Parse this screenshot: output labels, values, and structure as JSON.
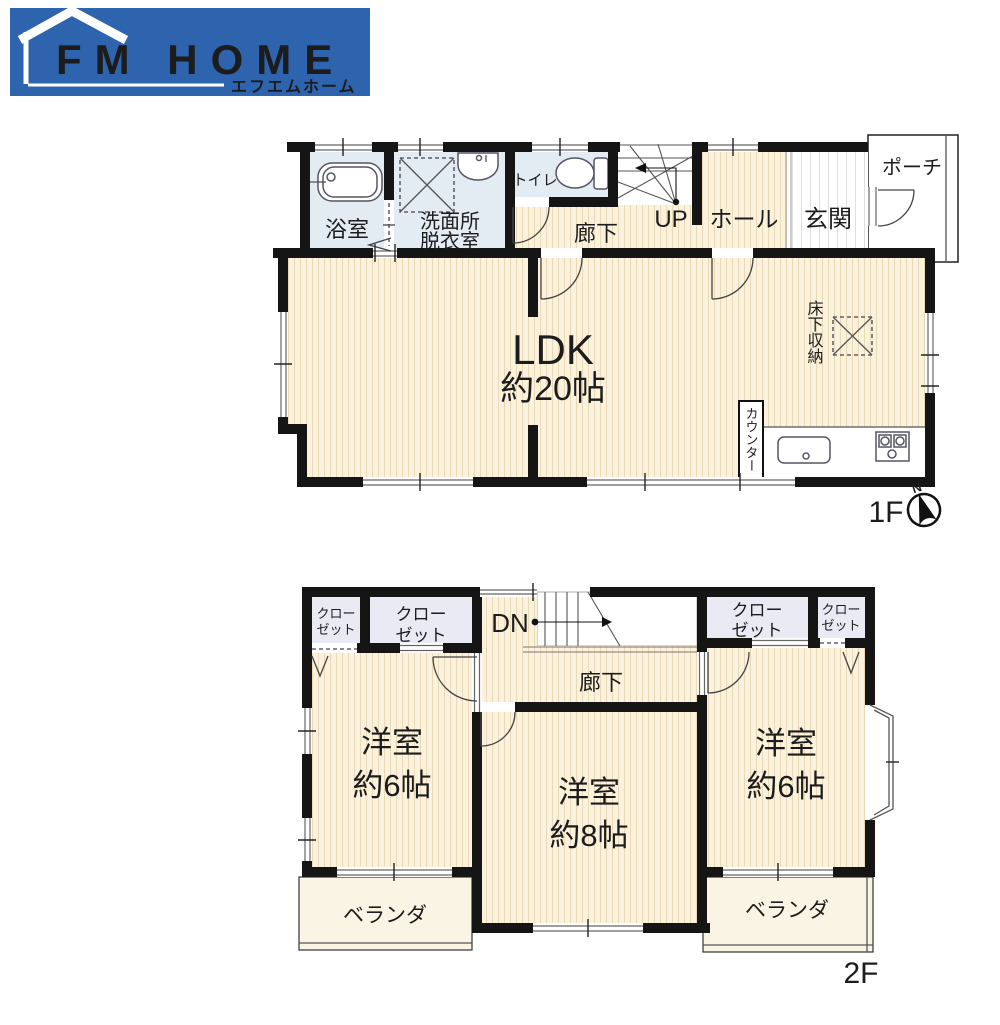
{
  "logo": {
    "brand": "FM HOME",
    "subtitle": "エフエムホーム"
  },
  "floor1": {
    "label": "1F",
    "compass_north": "N",
    "bath": "浴室",
    "washroom_line1": "洗面所",
    "washroom_line2": "脱衣室",
    "toilet": "トイレ",
    "corridor": "廊下",
    "stairs_label": "UP",
    "hall": "ホール",
    "entrance": "玄関",
    "porch": "ポーチ",
    "ldk_name": "LDK",
    "ldk_size": "約20帖",
    "underfloor_storage": "床下収納",
    "counter": "カウンター"
  },
  "floor2": {
    "label": "2F",
    "closet_line1": "クロー",
    "closet_line2": "ゼット",
    "stairs_label": "DN",
    "corridor": "廊下",
    "room_west": {
      "name": "洋室",
      "size": "約6帖"
    },
    "room_center": {
      "name": "洋室",
      "size": "約8帖"
    },
    "room_east": {
      "name": "洋室",
      "size": "約6帖"
    },
    "veranda_west": "ベランダ",
    "veranda_east": "ベランダ"
  },
  "colors": {
    "logo_blue": "#2e63ae",
    "wall": "#151515",
    "floor_cream": "#faf2dd",
    "floor_stripe": "#e9d9b6",
    "floor_wet": "#e3ebf3",
    "floor_closet": "#e9eaf4",
    "floor_veranda": "#f9f4e3"
  }
}
